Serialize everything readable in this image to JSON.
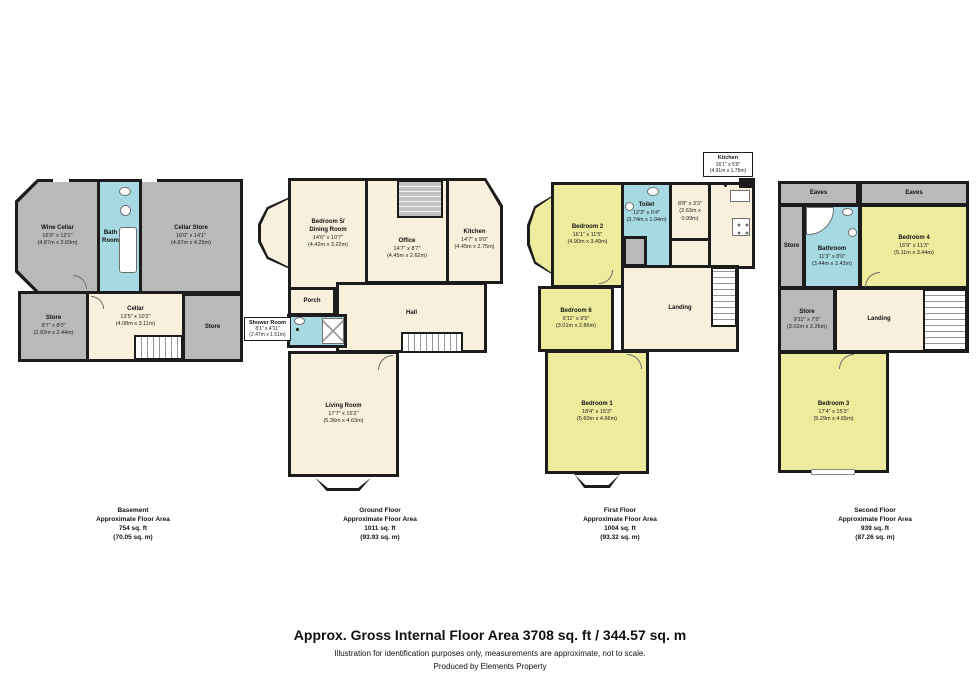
{
  "palette": {
    "wall": "#1c1c1c",
    "storage_gray": "#b9b9b9",
    "wet_room_blue": "#a6d9e2",
    "room_cream": "#f8f0dc",
    "bedroom_yellow": "#eeeb9c"
  },
  "basement": {
    "caption": {
      "title": "Basement",
      "sub": "Approximate Floor Area",
      "ft": "754 sq. ft",
      "m": "(70.05 sq. m)"
    },
    "rooms": {
      "wine_cellar": {
        "name": "Wine Cellar",
        "dims": "16'0\" x 12'1\"",
        "metric": "(4.87m x 3.69m)"
      },
      "bath_room": {
        "name": "Bath\nRoom"
      },
      "cellar_store": {
        "name": "Cellar Store",
        "dims": "16'0\" x 14'1\"",
        "metric": "(4.87m x 4.29m)"
      },
      "store_left": {
        "name": "Store",
        "dims": "9'7\" x 8'0\"",
        "metric": "(2.92m x 2.44m)"
      },
      "cellar": {
        "name": "Cellar",
        "dims": "13'5\" x 10'2\"",
        "metric": "(4.08m x 3.11m)"
      },
      "store_right": {
        "name": "Store"
      }
    }
  },
  "ground": {
    "caption": {
      "title": "Ground Floor",
      "sub": "Approximate Floor Area",
      "ft": "1011 sq. ft",
      "m": "(93.93 sq. m)"
    },
    "rooms": {
      "bedroom5": {
        "name": "Bedroom 5/\nDining Room",
        "dims": "14'6\" x 10'7\"",
        "metric": "(4.42m x 3.22m)"
      },
      "office": {
        "name": "Office",
        "dims": "14'7\" x 8'7\"",
        "metric": "(4.45m x 2.62m)"
      },
      "kitchen": {
        "name": "Kitchen",
        "dims": "14'7\" x 9'0\"",
        "metric": "(4.45m x 2.75m)"
      },
      "porch": {
        "name": "Porch"
      },
      "hall": {
        "name": "Hall"
      },
      "shower_room": {
        "name": "Shower Room",
        "dims": "8'1\" x 4'11\"",
        "metric": "(2.47m x 1.51m)"
      },
      "living_room": {
        "name": "Living Room",
        "dims": "17'7\" x 15'2\"",
        "metric": "(5.36m x 4.63m)"
      }
    }
  },
  "first": {
    "caption": {
      "title": "First Floor",
      "sub": "Approximate Floor Area",
      "ft": "1004 sq. ft",
      "m": "(93.32 sq. m)"
    },
    "rooms": {
      "kitchen": {
        "name": "Kitchen",
        "dims": "16'1\" x 5'9\"",
        "metric": "(4.91m x 1.75m)"
      },
      "bedroom2": {
        "name": "Bedroom 2",
        "dims": "16'1\" x 11'5\"",
        "metric": "(4.90m x 3.49m)"
      },
      "toilet": {
        "name": "Toilet",
        "dims": "12'3\" x 6'4\"",
        "metric": "(3.74m x 1.94m)"
      },
      "box_room": {
        "dims": "8'8\" x 3'3\"",
        "metric": "(2.63m x 0.99m)"
      },
      "bedroom6": {
        "name": "Bedroom 6",
        "dims": "9'11\" x 9'5\"",
        "metric": "(3.01m x 2.86m)"
      },
      "landing": {
        "name": "Landing"
      },
      "bedroom1": {
        "name": "Bedroom 1",
        "dims": "18'4\" x 15'3\"",
        "metric": "(5.60m x 4.66m)"
      }
    }
  },
  "second": {
    "caption": {
      "title": "Second Floor",
      "sub": "Approximate Floor Area",
      "ft": "939 sq. ft",
      "m": "(87.26 sq. m)"
    },
    "rooms": {
      "eaves_left": {
        "name": "Eaves"
      },
      "eaves_right": {
        "name": "Eaves"
      },
      "store_left": {
        "name": "Store"
      },
      "bathroom": {
        "name": "Bathroom",
        "dims": "11'3\" x 8'0\"",
        "metric": "(3.44m x 2.43m)"
      },
      "bedroom4": {
        "name": "Bedroom 4",
        "dims": "16'9\" x 11'3\"",
        "metric": "(5.11m x 3.44m)"
      },
      "store_mid": {
        "name": "Store",
        "dims": "9'11\" x 7'5\"",
        "metric": "(3.02m x 2.26m)"
      },
      "landing": {
        "name": "Landing"
      },
      "bedroom3": {
        "name": "Bedroom 3",
        "dims": "17'4\" x 15'3\"",
        "metric": "(5.29m x 4.65m)"
      }
    }
  },
  "footer": {
    "title": "Approx. Gross Internal Floor Area 3708 sq. ft / 344.57 sq. m",
    "disclaimer": "Illustration for identification purposes only, measurements are approximate, not to scale.",
    "credit": "Produced by Elements Property"
  }
}
